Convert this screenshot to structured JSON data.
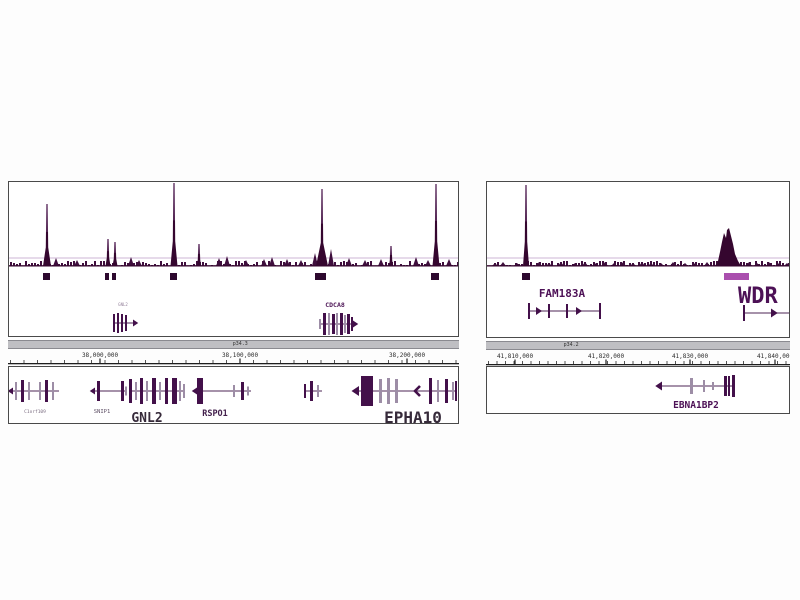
{
  "colors": {
    "signal": "#35062f",
    "signal_light": "#8a5c92",
    "noise": "#3f0e3d",
    "light_line": "#cdb6d4",
    "box_dark": "#2d082e",
    "box_light": "#aa4fae",
    "bar_dark": "#43104a",
    "bar_light": "#9d8da6",
    "gene_line": "#6b4a72",
    "axis_text": "#2b2b2b",
    "axis_line": "#1e1e1e",
    "tick": "#555555",
    "ideo_fill": "#bfbfc3",
    "ideo_border": "#8a8a90",
    "panel_border": "#4a4a4a",
    "background": "#fdfdfd"
  },
  "panels": [
    {
      "name": "left",
      "ideogram_label": "p34.3",
      "axis": {
        "minor_step": 13.5,
        "labels": [
          {
            "text": "38,000,000",
            "cx": 92
          },
          {
            "text": "38,100,000",
            "cx": 232
          },
          {
            "text": "38,200,000",
            "cx": 399
          }
        ]
      },
      "signal": {
        "noise_seed": 97,
        "peaks": [
          {
            "x": 38,
            "h": 62,
            "w": 8
          },
          {
            "x": 99,
            "h": 27,
            "w": 5
          },
          {
            "x": 106,
            "h": 24,
            "w": 5
          },
          {
            "x": 165,
            "h": 83,
            "w": 7
          },
          {
            "x": 190,
            "h": 22,
            "w": 4
          },
          {
            "x": 313,
            "h": 77,
            "w": 12
          },
          {
            "x": 382,
            "h": 20,
            "w": 4
          },
          {
            "x": 427,
            "h": 82,
            "w": 7
          }
        ],
        "bumps": [
          [
            47,
            8
          ],
          [
            68,
            6
          ],
          [
            122,
            9
          ],
          [
            130,
            6
          ],
          [
            210,
            8
          ],
          [
            218,
            10
          ],
          [
            237,
            6
          ],
          [
            255,
            7
          ],
          [
            263,
            9
          ],
          [
            278,
            7
          ],
          [
            292,
            6
          ],
          [
            306,
            13
          ],
          [
            322,
            17
          ],
          [
            340,
            8
          ],
          [
            356,
            6
          ],
          [
            372,
            7
          ],
          [
            407,
            9
          ],
          [
            419,
            6
          ],
          [
            440,
            7
          ]
        ]
      },
      "peak_boxes": [
        {
          "x": 34,
          "w": 7,
          "c": "d"
        },
        {
          "x": 96,
          "w": 4,
          "c": "d"
        },
        {
          "x": 103,
          "w": 4,
          "c": "d"
        },
        {
          "x": 161,
          "w": 7,
          "c": "d"
        },
        {
          "x": 306,
          "w": 11,
          "c": "d"
        },
        {
          "x": 422,
          "w": 8,
          "c": "d"
        }
      ],
      "mid_genes": [
        {
          "label": "GNL2",
          "label_px": 4,
          "label_cx": 114,
          "label_y": 124,
          "label_color": "#93809a",
          "bold": false,
          "x": 104,
          "w": 22,
          "line_y": 141,
          "bars": [
            [
              0,
              2,
              18,
              "d"
            ],
            [
              4,
              2,
              20,
              "d"
            ],
            [
              8,
              2,
              18,
              "d"
            ],
            [
              12,
              2,
              16,
              "d"
            ]
          ],
          "arrows": [
            [
              20,
              "right",
              7
            ]
          ]
        },
        {
          "label": "CDCA8",
          "label_px": 6.5,
          "label_cx": 326,
          "label_y": 125,
          "label_color": "#4d1556",
          "bold": true,
          "x": 310,
          "w": 34,
          "line_y": 142,
          "bars": [
            [
              0,
              2,
              10,
              "l"
            ],
            [
              4,
              3,
              22,
              "d"
            ],
            [
              9,
              2,
              22,
              "l"
            ],
            [
              13,
              3,
              20,
              "d"
            ],
            [
              17,
              2,
              22,
              "l"
            ],
            [
              21,
              3,
              22,
              "d"
            ],
            [
              25,
              2,
              18,
              "l"
            ],
            [
              28,
              3,
              20,
              "d"
            ],
            [
              32,
              2,
              14,
              "d"
            ]
          ],
          "arrows": [
            [
              34,
              "right",
              7
            ]
          ]
        }
      ],
      "bottom_genes": [
        {
          "label": "C1orf109",
          "label_px": 4.5,
          "label_cx": 26,
          "label_y": 46,
          "label_color": "#7a6c80",
          "bold": false,
          "x": 4,
          "w": 46,
          "line_y": 24,
          "bars": [
            [
              2,
              2,
              18,
              "l"
            ],
            [
              8,
              3,
              22,
              "d"
            ],
            [
              15,
              2,
              18,
              "l"
            ],
            [
              26,
              2,
              18,
              "l"
            ],
            [
              32,
              3,
              22,
              "d"
            ],
            [
              39,
              2,
              18,
              "l"
            ]
          ],
          "arrows": [
            [
              0,
              "left",
              7
            ]
          ]
        },
        {
          "label": "SNIP1",
          "label_px": 5.5,
          "label_cx": 93,
          "label_y": 46,
          "label_color": "#5f5066",
          "bold": false,
          "x": 86,
          "w": 32,
          "line_y": 24,
          "bars": [
            [
              2,
              3,
              20,
              "d"
            ],
            [
              26,
              3,
              20,
              "d"
            ],
            [
              30,
              2,
              9,
              "l"
            ]
          ],
          "arrows": [
            [
              0,
              "left",
              7
            ]
          ]
        },
        {
          "label": "GNL2",
          "label_px": 13,
          "label_cx": 138,
          "label_y": 55,
          "label_color": "#362a3a",
          "bold": true,
          "x": 120,
          "w": 56,
          "line_y": 24,
          "bars": [
            [
              0,
              3,
              24,
              "d"
            ],
            [
              6,
              2,
              18,
              "l"
            ],
            [
              11,
              3,
              26,
              "d"
            ],
            [
              17,
              2,
              20,
              "l"
            ],
            [
              23,
              4,
              26,
              "d"
            ],
            [
              30,
              2,
              18,
              "l"
            ],
            [
              36,
              3,
              26,
              "d"
            ],
            [
              43,
              5,
              26,
              "d"
            ],
            [
              50,
              2,
              20,
              "l"
            ],
            [
              54,
              2,
              14,
              "l"
            ]
          ],
          "arrows": []
        },
        {
          "label": "RSPO1",
          "label_px": 8.5,
          "label_cx": 206,
          "label_y": 49,
          "label_color": "#43204c",
          "bold": true,
          "x": 188,
          "w": 54,
          "line_y": 24,
          "bars": [
            [
              0,
              6,
              26,
              "d"
            ],
            [
              36,
              2,
              12,
              "l"
            ],
            [
              44,
              3,
              18,
              "d"
            ],
            [
              50,
              2,
              9,
              "l"
            ]
          ],
          "arrows": [
            [
              0,
              "left",
              7
            ]
          ]
        },
        {
          "label": "",
          "x": 295,
          "w": 18,
          "line_y": 24,
          "bars": [
            [
              0,
              2,
              14,
              "d"
            ],
            [
              6,
              3,
              20,
              "d"
            ],
            [
              13,
              2,
              12,
              "l"
            ]
          ],
          "arrows": []
        },
        {
          "label": "EPHA10",
          "label_px": 16,
          "label_cx": 404,
          "label_y": 56,
          "label_color": "#362a3a",
          "bold": true,
          "x": 348,
          "w": 100,
          "line_y": 24,
          "bars": [
            [
              4,
              12,
              30,
              "d"
            ],
            [
              22,
              3,
              24,
              "l"
            ],
            [
              30,
              3,
              26,
              "l"
            ],
            [
              38,
              3,
              24,
              "l"
            ],
            [
              72,
              3,
              26,
              "d"
            ],
            [
              80,
              2,
              22,
              "l"
            ],
            [
              88,
              3,
              24,
              "d"
            ],
            [
              95,
              2,
              18,
              "l"
            ],
            [
              98,
              2,
              20,
              "d"
            ]
          ],
          "arrows": [
            [
              2,
              "left",
              10
            ]
          ],
          "chevrons": [
            [
              58,
              "left"
            ]
          ]
        }
      ]
    },
    {
      "name": "right",
      "ideogram_label": "p34.2",
      "axis": {
        "minor_step": 8.5,
        "labels": [
          {
            "text": "41,810,000",
            "cx": 29
          },
          {
            "text": "41,820,000",
            "cx": 120
          },
          {
            "text": "41,830,000",
            "cx": 204
          },
          {
            "text": "41,840,000",
            "cx": 289
          }
        ]
      },
      "signal": {
        "noise_seed": 41,
        "peaks": [
          {
            "x": 39,
            "h": 81,
            "w": 6
          }
        ],
        "broad": [
          [
            228,
            0
          ],
          [
            231,
            5
          ],
          [
            233,
            14
          ],
          [
            235,
            24
          ],
          [
            237,
            33
          ],
          [
            239,
            28
          ],
          [
            240,
            36
          ],
          [
            242,
            38
          ],
          [
            244,
            30
          ],
          [
            246,
            22
          ],
          [
            248,
            12
          ],
          [
            251,
            5
          ],
          [
            254,
            0
          ]
        ],
        "bumps": [
          [
            8,
            3
          ],
          [
            16,
            4
          ],
          [
            30,
            3
          ],
          [
            52,
            4
          ],
          [
            62,
            3
          ],
          [
            74,
            4
          ],
          [
            88,
            3
          ],
          [
            98,
            4
          ],
          [
            108,
            3
          ],
          [
            118,
            4
          ],
          [
            127,
            3
          ],
          [
            136,
            4
          ],
          [
            146,
            3
          ],
          [
            155,
            4
          ],
          [
            164,
            3
          ],
          [
            174,
            3
          ],
          [
            186,
            4
          ],
          [
            198,
            3
          ],
          [
            208,
            3
          ],
          [
            220,
            4
          ],
          [
            262,
            4
          ],
          [
            270,
            3
          ],
          [
            282,
            4
          ],
          [
            292,
            3
          ],
          [
            300,
            3
          ]
        ]
      },
      "peak_boxes": [
        {
          "x": 35,
          "w": 8,
          "c": "d"
        },
        {
          "x": 237,
          "w": 25,
          "c": "l"
        }
      ],
      "mid_genes": [
        {
          "label": "FAM183A",
          "label_px": 11,
          "label_cx": 75,
          "label_y": 115,
          "label_color": "#4d1156",
          "bold": true,
          "x": 41,
          "w": 73,
          "line_y": 129,
          "bars": [
            [
              0,
              2,
              16,
              "d"
            ],
            [
              20,
              2,
              14,
              "d"
            ],
            [
              38,
              2,
              14,
              "d"
            ],
            [
              71,
              2,
              16,
              "d"
            ]
          ],
          "arrows": [
            [
              8,
              "right",
              8
            ],
            [
              48,
              "right",
              8
            ]
          ]
        },
        {
          "label": "WDR",
          "label_px": 22,
          "label_anchor": "start",
          "label_x": 251,
          "label_cx": 277,
          "label_y": 121,
          "label_color": "#4d1156",
          "bold": true,
          "x": 256,
          "w": 48,
          "line_y": 131,
          "bars": [
            [
              0,
              2,
              16,
              "d"
            ]
          ],
          "arrows": [
            [
              28,
              "right",
              9
            ]
          ]
        }
      ],
      "bottom_genes": [
        {
          "label": "EBNA1BP2",
          "label_px": 9.5,
          "label_cx": 209,
          "label_y": 41,
          "label_color": "#4d1156",
          "bold": true,
          "x": 175,
          "w": 72,
          "line_y": 19,
          "bars": [
            [
              28,
              3,
              16,
              "l"
            ],
            [
              41,
              2,
              12,
              "l"
            ],
            [
              50,
              2,
              8,
              "l"
            ],
            [
              62,
              3,
              20,
              "d"
            ],
            [
              66,
              2,
              20,
              "d"
            ],
            [
              70,
              3,
              22,
              "d"
            ]
          ],
          "arrows": [
            [
              0,
              "left",
              9
            ]
          ]
        }
      ]
    }
  ]
}
